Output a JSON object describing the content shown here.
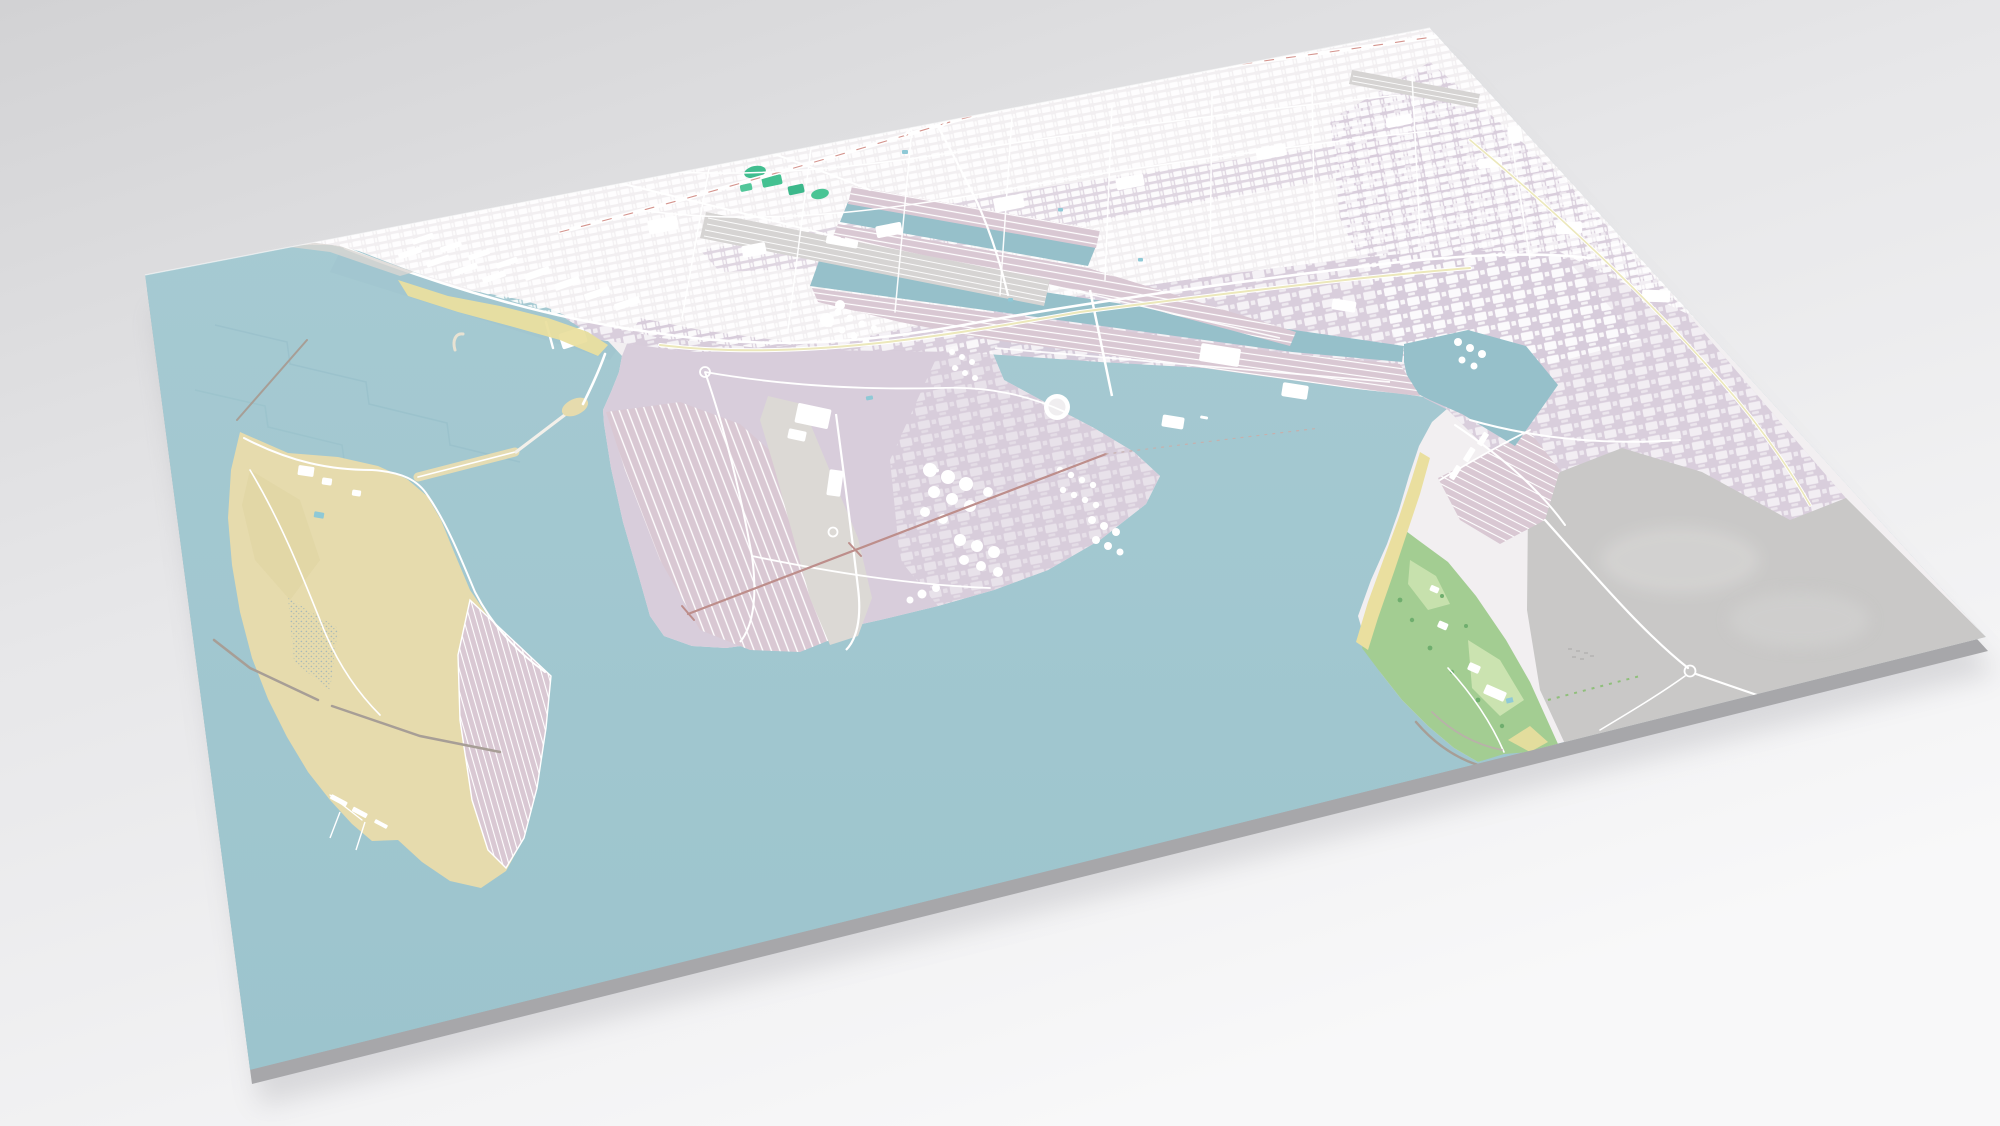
{
  "scene": {
    "kind": "3d-map-diorama",
    "view": "oblique aerial render of a flat map slab on a neutral studio background",
    "subject": "coastal industrial port city with container piers, dock basins, tank farms, reclaimed sand island, seaside park and open bay",
    "visible_text": "none"
  },
  "palette": {
    "background_top": "#d2d2d4",
    "background_mid": "#e7e7e9",
    "background_bottom": "#f8f8f9",
    "water_light": "#a8cbd3",
    "water": "#9cc4cd",
    "water_deep": "#96c0ca",
    "land": "#f2eff1",
    "industrial": "#d7cbda",
    "industrial_dark": "#cfc1d3",
    "pier": "#d9c8d3",
    "sand": "#e6dbad",
    "beach": "#eadf9f",
    "apron": "#dcd9d5",
    "rail_yard": "#d6d4d3",
    "field": "#c9c8c7",
    "field_light": "#d5d4d3",
    "park": "#a3cd92",
    "park_light": "#cfe6b4",
    "sport_green": "#41bd8f",
    "tree_green": "#6fae6e",
    "road": "#ffffff",
    "road_yellow": "#ece8bb",
    "route_red": "#d4948e",
    "trestle": "#bd8e8b",
    "breakwater": "#a79e96",
    "pond": "#8fc9d6",
    "building": "#ffffff",
    "slab_side": "#a7a7aa",
    "shadow": "#7e7e86",
    "marsh_dot": "#9fb4b9",
    "step_shade": "#8fb9c4"
  },
  "features": [
    {
      "name": "harbor-bay",
      "kind": "water"
    },
    {
      "name": "mainland-city",
      "kind": "urban-area"
    },
    {
      "name": "warehouse-district",
      "kind": "industrial"
    },
    {
      "name": "rail-yard",
      "kind": "railway"
    },
    {
      "name": "expressway-interchange",
      "kind": "road"
    },
    {
      "name": "sports-fields",
      "kind": "recreation"
    },
    {
      "name": "dock-basin-upper",
      "kind": "water-basin"
    },
    {
      "name": "dock-basin-lower",
      "kind": "water-basin"
    },
    {
      "name": "finger-pier",
      "kind": "container-pier"
    },
    {
      "name": "long-container-pier",
      "kind": "container-pier"
    },
    {
      "name": "east-channel",
      "kind": "water-channel"
    },
    {
      "name": "central-terminal",
      "kind": "industrial-pier"
    },
    {
      "name": "tank-farm",
      "kind": "oil-storage"
    },
    {
      "name": "gas-holder",
      "kind": "oil-storage"
    },
    {
      "name": "sand-island",
      "kind": "landfill-island"
    },
    {
      "name": "island-container-yard",
      "kind": "container-yard"
    },
    {
      "name": "island-quay",
      "kind": "quay"
    },
    {
      "name": "breakwater-chain",
      "kind": "breakwater"
    },
    {
      "name": "sea-trestle",
      "kind": "jetty"
    },
    {
      "name": "eastern-district",
      "kind": "urban-area"
    },
    {
      "name": "open-field",
      "kind": "undeveloped-land"
    },
    {
      "name": "seaside-park",
      "kind": "park"
    },
    {
      "name": "bathing-beach",
      "kind": "beach"
    },
    {
      "name": "small-craft-harbor",
      "kind": "marina"
    }
  ]
}
